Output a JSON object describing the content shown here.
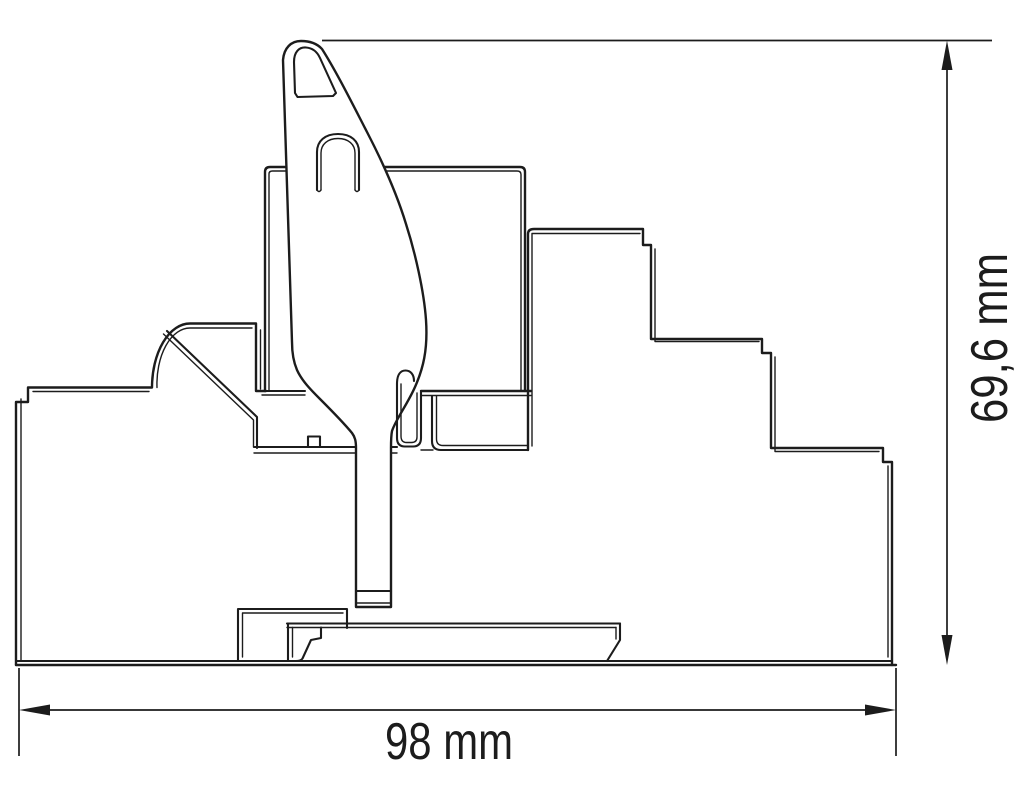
{
  "canvas": {
    "background": "#ffffff",
    "line_color": "#1c1c1c"
  },
  "drawing": {
    "kind": "technical-dimension-drawing-side-view",
    "components": [
      "socket-housing-left",
      "relay-body",
      "socket-housing-right",
      "din-rail-mount",
      "ejector-lever",
      "latch-finger"
    ],
    "dimensions": {
      "width": {
        "label": "98 mm",
        "orientation": "horizontal"
      },
      "height": {
        "label": "69,6 mm",
        "orientation": "vertical"
      }
    }
  }
}
